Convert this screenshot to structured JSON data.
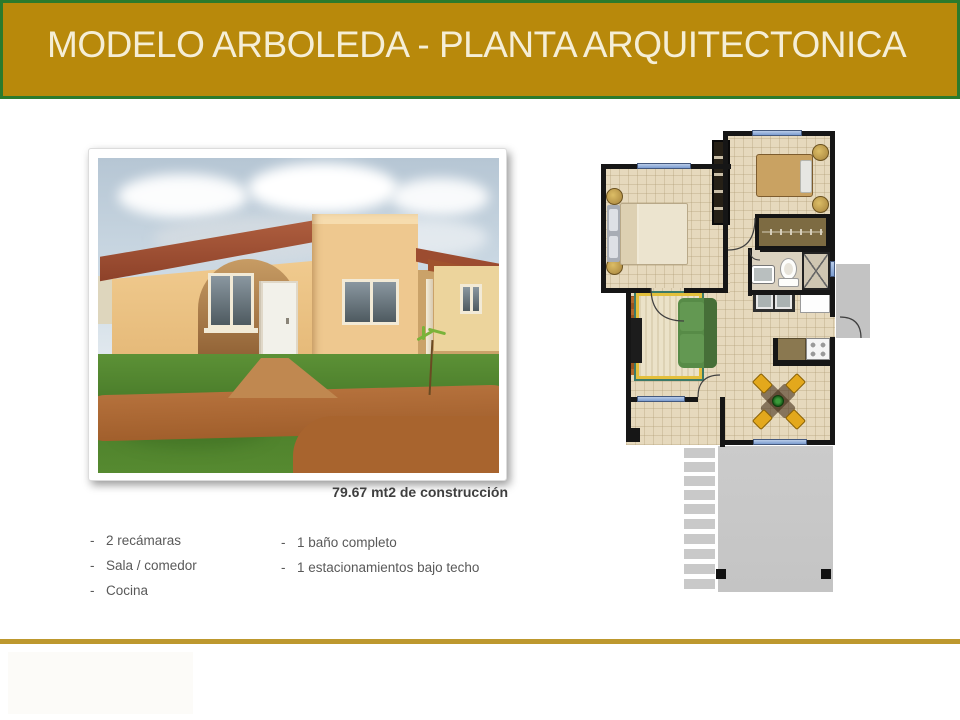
{
  "slide": {
    "title": "MODELO ARBOLEDA - PLANTA ARQUITECTONICA",
    "area_caption": "79.67 mt2 de construcción",
    "features_col1": [
      {
        "marker": "-",
        "text": "2 recámaras"
      },
      {
        "marker": "-",
        "text": "Sala / comedor"
      },
      {
        "marker": "-",
        "text": "Cocina"
      }
    ],
    "features_col2": [
      {
        "marker": "-",
        "text": "1 baño completo"
      },
      {
        "marker": "-",
        "text": "1 estacionamientos bajo techo"
      }
    ],
    "colors": {
      "banner_gold": "#B8890B",
      "banner_border_green": "#2C7A2C",
      "title_text": "#F5EED6",
      "divider_gold": "#BD982E",
      "plan_floor_beige": "#E6D9BD",
      "plan_wall_black": "#161616",
      "plan_window_blue": "#7B9CD0",
      "sofa_green": "#578B47",
      "chair_yellow": "#E3A81C"
    }
  }
}
